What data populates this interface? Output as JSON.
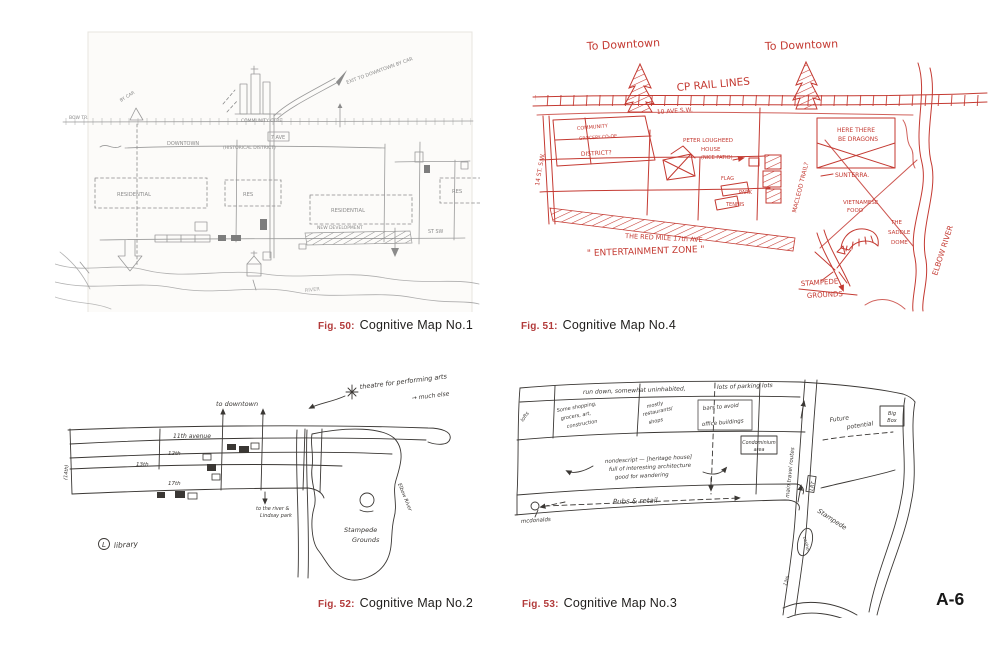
{
  "page": {
    "number": "A-6"
  },
  "colors": {
    "caption_fig_red": "#b23a3a",
    "pencil_grey": "#8b8b8b",
    "red_ink": "#c43a32",
    "black_ink": "#3a3734"
  },
  "captions": [
    {
      "fig": "Fig. 50:",
      "title": "Cognitive Map No.1"
    },
    {
      "fig": "Fig. 51:",
      "title": "Cognitive Map No.4"
    },
    {
      "fig": "Fig. 52:",
      "title": "Cognitive Map No.2"
    },
    {
      "fig": "Fig. 53:",
      "title": "Cognitive Map No.3"
    }
  ],
  "map1": {
    "labels": {
      "by_car": "BY CAR",
      "bow_tr": "BOW TR.",
      "downtown": "DOWNTOWN",
      "district": "(HISTORICAL DISTRICT)",
      "seven_ave": "7 AVE",
      "community_ctre": "COMMUNITY CTRE",
      "exit_car": "EXIT TO DOWNTOWN BY CAR",
      "residential_w": "RESIDENTIAL",
      "res_n": "RES",
      "residential_e": "RESIDENTIAL",
      "res_e": "RES",
      "new_dev": "NEW DEVELOPMENT",
      "st_sw": "ST SW",
      "river": "RIVER"
    }
  },
  "map4": {
    "labels": {
      "to_downtown_1": "To Downtown",
      "to_downtown_2": "To Downtown",
      "cp_rail": "CP RAIL LINES",
      "ave10": "10 AVE S.W.",
      "st14": "14 ST. S.W.",
      "community": "COMMUNITY",
      "coop": "GROCERY CO-OP",
      "district": "DISTRICT?",
      "lougheed1": "PETER LOUGHEED",
      "lougheed2": "HOUSE",
      "lougheed3": "(NICE PATIO)",
      "flag": "FLAG",
      "park": "PARK",
      "tennis": "TENNIS",
      "dragons1": "HERE THERE",
      "dragons2": "BE DRAGONS",
      "macleod": "MACLEOD TRAIL?",
      "sunterra": "SUNTERRA.",
      "viet1": "VIETNAMESE",
      "viet2": "FOOD",
      "dome1": "THE",
      "dome2": "SADDLE",
      "dome3": "DOME",
      "stampede1": "STAMPEDE",
      "stampede2": "GROUNDS",
      "elbow": "ELBOW RIVER",
      "red_mile": "THE RED MILE 17th AVE",
      "ent_zone": "\" ENTERTAINMENT ZONE \""
    }
  },
  "map2": {
    "labels": {
      "note1": "theatre for performing arts",
      "note2": "→ much else",
      "to_downtown": "to downtown",
      "ave11": "11th avenue",
      "ave12": "12th",
      "ave13": "13th",
      "ave14": "(14th)",
      "ave17": "17th",
      "to_river1": "to the river &",
      "to_river2": "Lindsay park",
      "library_letter": "L",
      "library": "library",
      "stampede1": "Stampede",
      "stampede2": "Grounds",
      "elbow": "Elbow River"
    }
  },
  "map3": {
    "labels": {
      "note_top": "run down, somewhat uninhabited,",
      "parking": "lots of parking lots",
      "lofts": "lofts",
      "shopping1": "Some shopping,",
      "shopping2": "grocers, art,",
      "shopping3": "construction",
      "rest1": "mostly",
      "rest2": "restaurants/",
      "rest3": "shops",
      "bars": "bars to avoid",
      "offices": "office buildings",
      "condo1": "Condominium",
      "condo2": "area",
      "heritage1": "nondescript — [heritage house]",
      "heritage2": "full of interesting architecture",
      "heritage3": "good for wandering",
      "pubs": "Pubs & retail",
      "mcdonalds": "mcdonalds",
      "main_routes": "main travel routes",
      "lrt": "LRT",
      "casino": "casino",
      "future1": "Future",
      "future2": "potential",
      "bigbox1": "Big",
      "bigbox2": "Box",
      "stampede": "Stampede",
      "th13": "13th"
    }
  }
}
